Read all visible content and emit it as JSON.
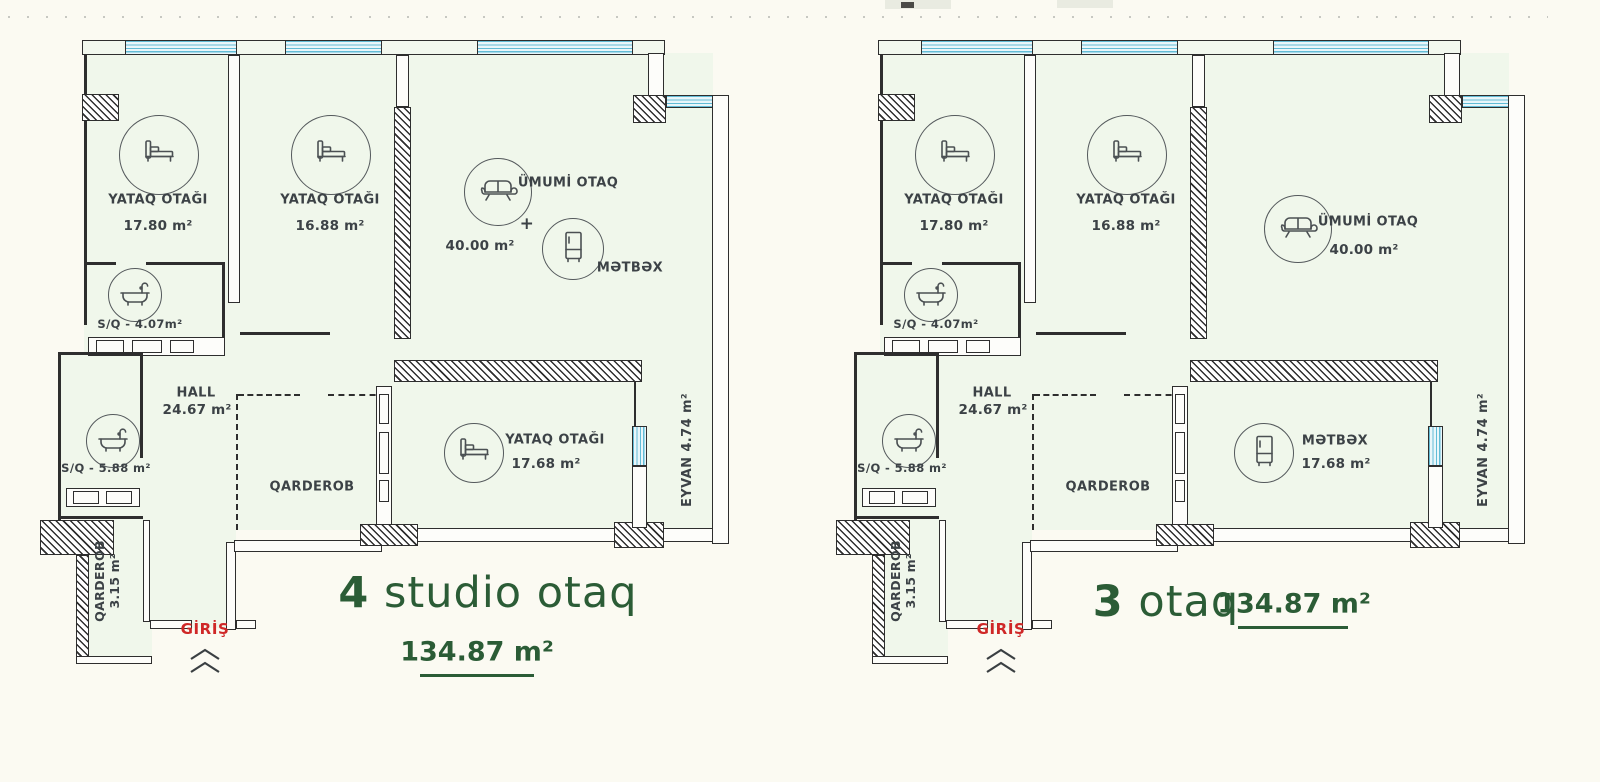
{
  "colors": {
    "accent_green": "#2b5c36",
    "entrance_red": "#cf2727",
    "window_blue": "#62bcd6",
    "wall_dark": "#2e2e2e",
    "floor_tint": "#f0f7eb"
  },
  "plans": [
    {
      "id": "left-plan",
      "title": {
        "number": "4",
        "text": " studio otaq",
        "area": "134.87 m²"
      },
      "entrance": {
        "label": "GİRİŞ"
      },
      "rooms": {
        "bedroom1": {
          "name": "YATAQ OTAĞI",
          "area": "17.80 m²"
        },
        "bedroom2": {
          "name": "YATAQ OTAĞI",
          "area": "16.88 m²"
        },
        "living": {
          "name": "ÜMUMİ OTAQ",
          "area": "40.00 m²",
          "plus": "+",
          "kitchen": "MƏTBƏX"
        },
        "bath_small": {
          "label": "S/Q - 4.07m²"
        },
        "hall": {
          "name": "HALL",
          "area": "24.67 m²"
        },
        "bath_large": {
          "label": "S/Q - 5.88 m²"
        },
        "wardrobe": {
          "name": "QARDEROB"
        },
        "bottom_room": {
          "name": "YATAQ OTAĞI",
          "area": "17.68 m²"
        },
        "balcony": {
          "label": "EYVAN 4.74 m²"
        },
        "wardrobe_wing": {
          "name": "QARDEROB",
          "area": "3.15 m²"
        }
      }
    },
    {
      "id": "right-plan",
      "title": {
        "number": "3",
        "text": " otaq",
        "area": "134.87 m²"
      },
      "entrance": {
        "label": "GİRİŞ"
      },
      "rooms": {
        "bedroom1": {
          "name": "YATAQ OTAĞI",
          "area": "17.80 m²"
        },
        "bedroom2": {
          "name": "YATAQ OTAĞI",
          "area": "16.88 m²"
        },
        "living": {
          "name": "ÜMUMİ OTAQ",
          "area": "40.00 m²"
        },
        "bath_small": {
          "label": "S/Q - 4.07m²"
        },
        "hall": {
          "name": "HALL",
          "area": "24.67 m²"
        },
        "bath_large": {
          "label": "S/Q - 5.88 m²"
        },
        "wardrobe": {
          "name": "QARDEROB"
        },
        "bottom_room": {
          "name": "MƏTBƏX",
          "area": "17.68 m²"
        },
        "balcony": {
          "label": "EYVAN 4.74 m²"
        },
        "wardrobe_wing": {
          "name": "QARDEROB",
          "area": "3.15 m²"
        }
      }
    }
  ]
}
